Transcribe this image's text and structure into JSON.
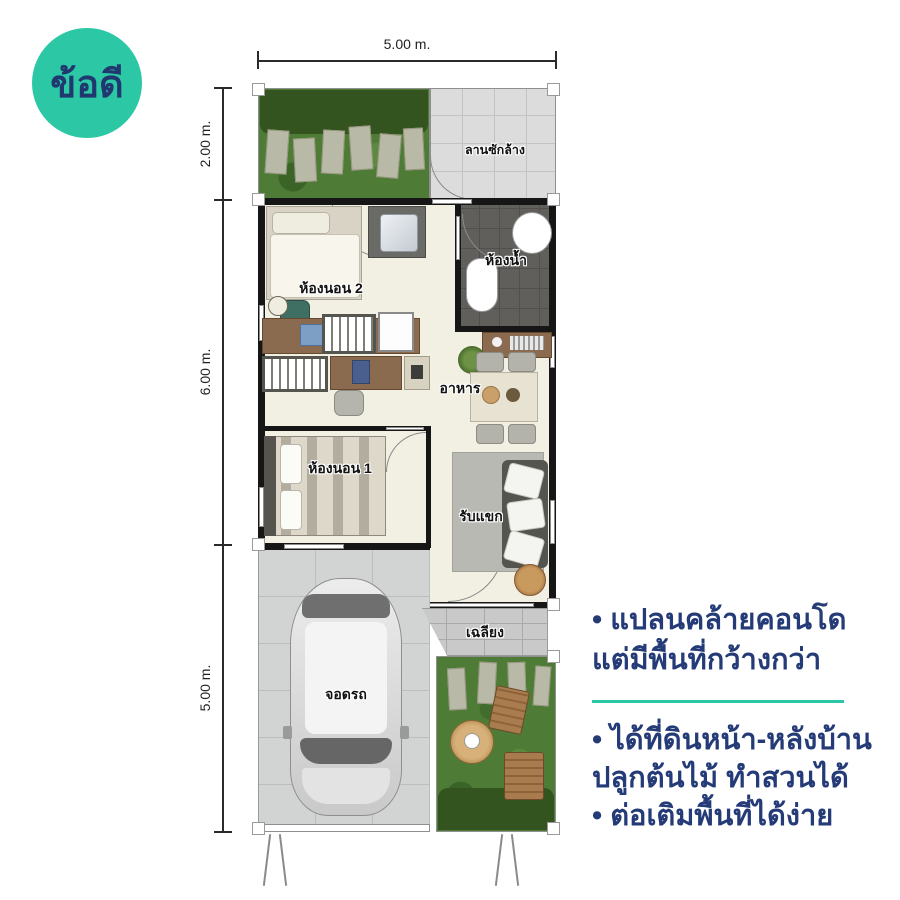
{
  "badge": {
    "label": "ข้อดี",
    "bg_color": "#2CC8A6",
    "text_color": "#20386F"
  },
  "dimensions": {
    "top": "5.00 m.",
    "left": [
      "2.00 m.",
      "6.00 m.",
      "5.00 m."
    ]
  },
  "rooms": {
    "laundry": "ลานซักล้าง",
    "bedroom2": "ห้องนอน 2",
    "bathroom": "ห้องน้ำ",
    "dining": "อาหาร",
    "bedroom1": "ห้องนอน 1",
    "living": "รับแขก",
    "porch": "เฉลียง",
    "parking": "จอดรถ"
  },
  "notes": {
    "n1l1": "• แปลนคล้ายคอนโด",
    "n1l2": "แต่มีพื้นที่กว้างกว่า",
    "n2l1": "• ได้ที่ดินหน้า-หลังบ้าน",
    "n2l2": "ปลูกต้นไม้ ทำสวนได้",
    "n3": "• ต่อเติมพื้นที่ได้ง่าย",
    "text_color": "#243B77",
    "divider_color": "#2CC8A6"
  }
}
